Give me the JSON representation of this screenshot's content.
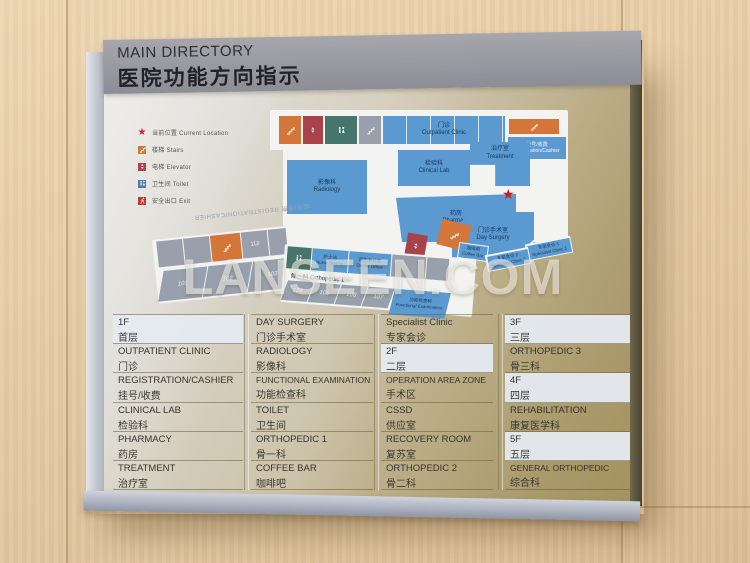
{
  "header": {
    "title_en": "MAIN DIRECTORY",
    "title_zh": "医院功能方向指示"
  },
  "legend": {
    "items": [
      {
        "zh": "当前位置",
        "en": "Current Location"
      },
      {
        "zh": "楼梯",
        "en": "Stairs"
      },
      {
        "zh": "电梯",
        "en": "Elevator"
      },
      {
        "zh": "卫生间",
        "en": "Toilet"
      },
      {
        "zh": "安全出口",
        "en": "Exit"
      }
    ],
    "colors": {
      "star": "#c03028",
      "stairs": "#d4763a",
      "elevator": "#a8434b",
      "toilet": "#4e7ba8",
      "exit": "#c8372f"
    }
  },
  "map": {
    "star": "★",
    "corridor_label_mirrored": "挂号/收费 REGISTRATION/CASHIER",
    "corridor_orthopedic": {
      "zh": "骨一科",
      "en": "Orthopedic 1"
    },
    "rooms": {
      "upper": "112",
      "lower": [
        "101",
        "102",
        "103",
        "104",
        "105",
        "106",
        "107"
      ]
    },
    "blocks": {
      "outpatient": {
        "zh": "门诊",
        "en": "Outpatient Clinic"
      },
      "registration": {
        "zh": "挂号/收费",
        "en": "Registration/Cashier"
      },
      "radiology": {
        "zh": "影像科",
        "en": "Radiology"
      },
      "clinical_lab": {
        "zh": "检验科",
        "en": "Clinical Lab"
      },
      "treatment": {
        "zh": "治疗室",
        "en": "Treatment"
      },
      "pharmacy": {
        "zh": "药房",
        "en": "Pharmacy"
      },
      "day_surgery": {
        "zh": "门诊手术室",
        "en": "Day Surgery"
      },
      "coffee_bar": {
        "zh": "咖啡吧",
        "en": "Coffee Bar"
      },
      "nurse_station": {
        "zh": "护士站",
        "en": "Nurse Station"
      },
      "doctor_office": {
        "zh": "医生办公室",
        "en": "Doctor Office"
      },
      "functional_exam": {
        "zh": "功能检查科",
        "en": "Functional Examination"
      },
      "specialist_1": {
        "zh": "专家会诊 1",
        "en": "Specialist Clinic 1"
      },
      "specialist_2": {
        "zh": "专家会诊 2",
        "en": "Specialist Clinic 2"
      }
    }
  },
  "watermark": "LANSEEN.COM",
  "directory": {
    "columns": [
      {
        "rows": [
          {
            "en": "1F",
            "zh": "首层"
          },
          {
            "en": "OUTPATIENT CLINIC",
            "zh": "门诊"
          },
          {
            "en": "REGISTRATION/CASHIER",
            "zh": "挂号/收费"
          },
          {
            "en": "CLINICAL LAB",
            "zh": "检验科"
          },
          {
            "en": "PHARMACY",
            "zh": "药房"
          },
          {
            "en": "TREATMENT",
            "zh": "治疗室"
          }
        ]
      },
      {
        "rows": [
          {
            "en": "DAY SURGERY",
            "zh": "门诊手术室"
          },
          {
            "en": "RADIOLOGY",
            "zh": "影像科"
          },
          {
            "en": "FUNCTIONAL EXAMINATION",
            "zh": "功能检查科"
          },
          {
            "en": "TOILET",
            "zh": "卫生间"
          },
          {
            "en": "ORTHOPEDIC 1",
            "zh": "骨一科"
          },
          {
            "en": "COFFEE BAR",
            "zh": "咖啡吧"
          }
        ]
      },
      {
        "rows": [
          {
            "en": "Specialist Clinic",
            "zh": "专家会诊"
          },
          {
            "en": "2F",
            "zh": "二层"
          },
          {
            "en": "OPERATION AREA ZONE",
            "zh": "手术区"
          },
          {
            "en": "CSSD",
            "zh": "供应室"
          },
          {
            "en": "RECOVERY ROOM",
            "zh": "复苏室"
          },
          {
            "en": "ORTHOPEDIC 2",
            "zh": "骨二科"
          }
        ]
      },
      {
        "rows": [
          {
            "en": "3F",
            "zh": "三层"
          },
          {
            "en": "ORTHOPEDIC 3",
            "zh": "骨三科"
          },
          {
            "en": "4F",
            "zh": "四层"
          },
          {
            "en": "REHABILITATION",
            "zh": "康复医学科"
          },
          {
            "en": "5F",
            "zh": "五层"
          },
          {
            "en": "GENERAL ORTHOPEDIC",
            "zh": "综合科"
          }
        ]
      }
    ]
  }
}
